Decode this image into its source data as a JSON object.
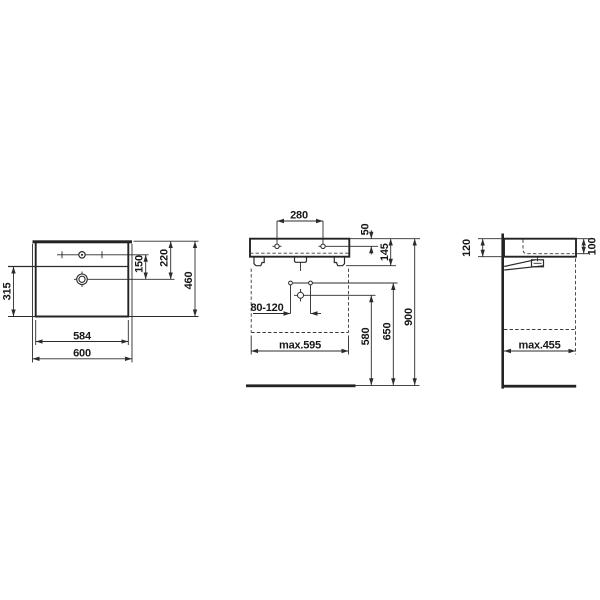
{
  "dims": {
    "plan": {
      "bowl_depth": "315",
      "body_width": "584",
      "total_width": "600",
      "tap_to_drain": "150",
      "back_to_drain": "220",
      "total_depth": "460"
    },
    "front": {
      "hole_spacing": "280",
      "rim_to_holes": "50",
      "height_with_fixings": "145",
      "supply_spacing_range": "80-120",
      "trap_height": "580",
      "supply_height": "650",
      "rim_height": "900",
      "max_clearance_width": "max.595"
    },
    "side": {
      "back_height": "120",
      "front_depth": "100",
      "max_clearance_depth": "max.455"
    }
  }
}
